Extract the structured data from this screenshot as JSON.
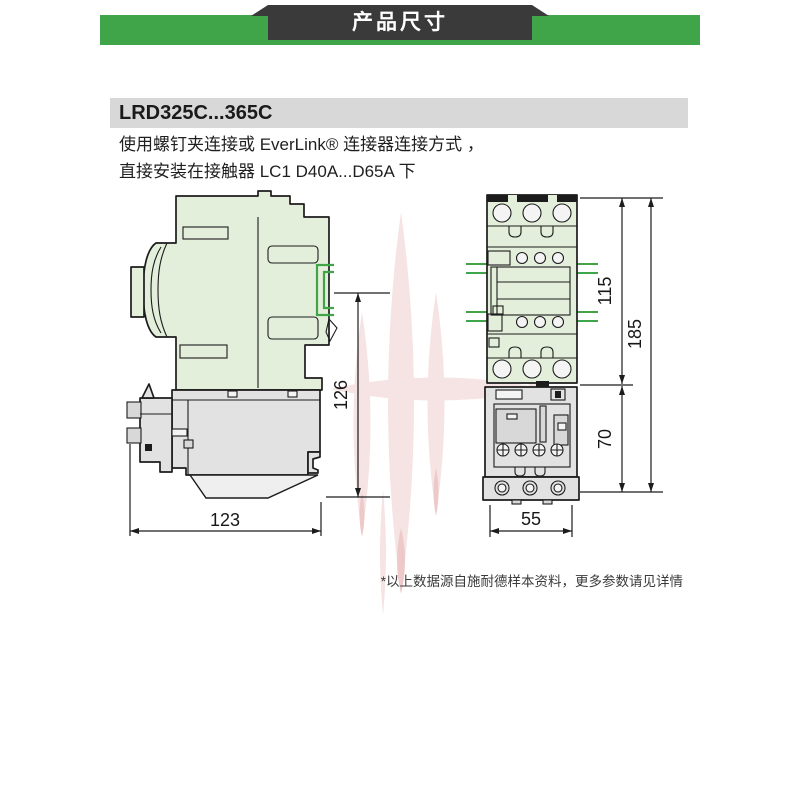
{
  "banner": {
    "label": "产品尺寸"
  },
  "product": {
    "title": "LRD325C...365C",
    "desc1": "使用螺钉夹连接或 EverLink® 连接器连接方式 ，",
    "desc2": "直接安装在接触器 LC1 D40A...D65A 下"
  },
  "dimensions": {
    "side_height": "126",
    "side_width": "123",
    "front_upper": "115",
    "front_total": "185",
    "front_lower": "70",
    "front_width": "55"
  },
  "colors": {
    "banner_green": "#3FA548",
    "ribbon_dark": "#3A3A3A",
    "accent_green": "#3FA548",
    "body_green": "#E4EFDB",
    "relay_gray": "#E2E2E2",
    "outline": "#1C1C1C",
    "title_bar_gray": "#D8D8D8"
  },
  "footnote": "*以上数据源自施耐德样本资料，更多参数请见详情"
}
